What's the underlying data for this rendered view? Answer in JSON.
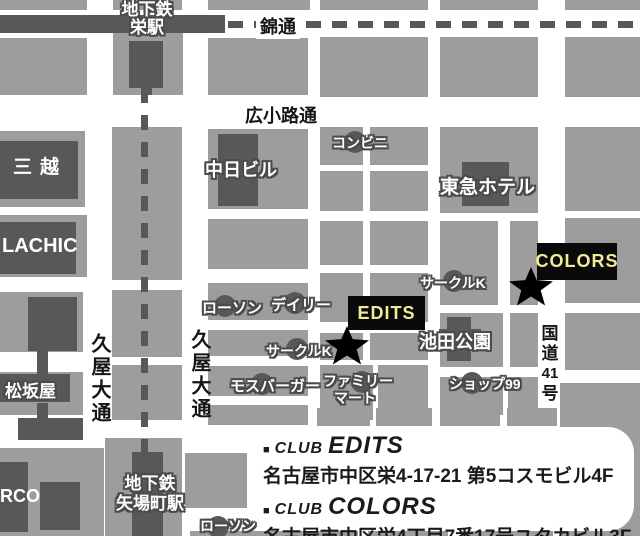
{
  "stations": {
    "sakae_line1": "地下鉄",
    "sakae_line2": "栄駅",
    "yabacho_line1": "地下鉄",
    "yabacho_line2": "矢場町駅"
  },
  "streets": {
    "nishiki": "錦通",
    "hirokoji": "広小路通",
    "hisaya_west": "久屋大通",
    "hisaya_east": "久屋大通",
    "route41_parts": [
      "国",
      "道",
      "41",
      "号"
    ]
  },
  "buildings": {
    "mitsukoshi": "三越",
    "chunichi": "中日ビル",
    "tokyu_hotel": "東急ホテル",
    "lachic": "LACHIC",
    "matsuzakaya": "松坂屋",
    "parco": "RCO",
    "ikeda_park": "池田公園"
  },
  "stores": {
    "conbini": "コンビニ",
    "lawson_north": "ローソン",
    "daily": "デイリー",
    "circle_k_west": "サークルK",
    "circle_k_east": "サークルK",
    "mos_burger": "モスバーガー",
    "family_mart_line1": "ファミリー",
    "family_mart_line2": "マート",
    "shop99": "ショップ99",
    "lawson_south": "ローソン"
  },
  "venues": {
    "edits": "EDITS",
    "colors": "COLORS"
  },
  "info_box": {
    "bullet": "■",
    "club_word": "CLUB",
    "edits_name": "EDITS",
    "edits_address": "名古屋市中区栄4-17-21 第5コスモビル4F",
    "colors_name": "COLORS",
    "colors_address": "名古屋市中区栄4丁目7番17号ユタカビル3F"
  },
  "colors": {
    "block_gray": "#9d9d9d",
    "dark_gray": "#58585a",
    "street_white": "#ffffff",
    "box_black": "#0a0a0a",
    "label_yellow": "#f1eb94"
  }
}
